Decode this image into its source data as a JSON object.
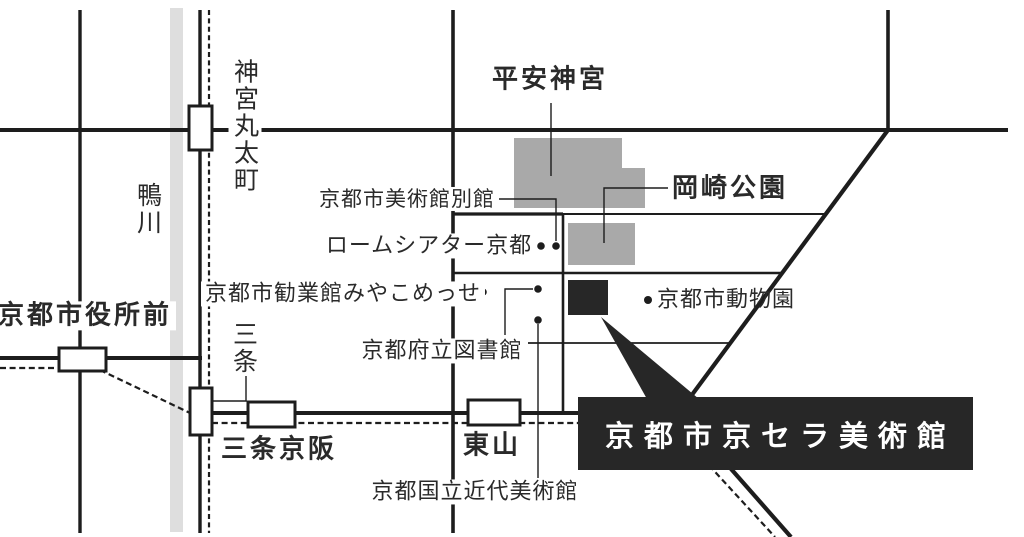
{
  "labels": {
    "heian_jingu": "平安神宮",
    "okazaki_park": "岡崎公園",
    "museum_annex": "京都市美術館別館",
    "rohm_theatre": "ロームシアター京都",
    "miyako_messe": "京都市勧業館みやこめっせ",
    "prefectural_library": "京都府立図書館",
    "kyoto_zoo": "京都市動物園",
    "modern_art_museum": "京都国立近代美術館",
    "kyocera_museum": "京都市京セラ美術館",
    "kamo_river": "鴨川",
    "stations": {
      "jingu_marutamachi": "神宮丸太町",
      "kyoto_shiyakushomae": "京都市役所前",
      "sanjo": "三条",
      "sanjo_keihan": "三条京阪",
      "higashiyama": "東山"
    }
  },
  "colors": {
    "line": "#1d1d1d",
    "text": "#2a2a2a",
    "park_gray": "#a9a9a9",
    "river_gray": "#dedede",
    "marker_black": "#272727",
    "station_fill": "#ffffff"
  }
}
